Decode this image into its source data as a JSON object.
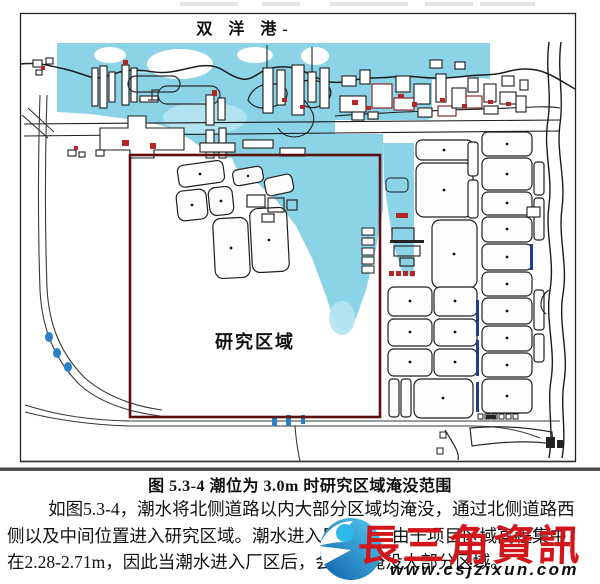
{
  "figure": {
    "port_label": "双  洋  港-",
    "study_area_label": "研究区域",
    "caption": "图 5.3-4  潮位为 3.0m 时研究区域淹没范围",
    "colors": {
      "flood": "#8bd3e7",
      "flood_light": "#b5e4f1",
      "study_area_border": "#5e1010",
      "map_line": "#1c1c1c",
      "road_marker_blue": "#2b7fc4"
    }
  },
  "paragraph": {
    "lines": [
      "如图5.3-4，潮水将北侧道路以内大部分区域均淹没，通过北侧道路西",
      "侧以及中间位置进入研究区域。潮水进入厂区后，由于项目区域高程集中",
      "在2.28-2.71m，因此当潮水进入厂区后，会迅速淹没大部分区域。"
    ]
  },
  "watermark": {
    "brand": "長三角資訊",
    "url": "www.csjzixun.com",
    "brand_color": "#d2171c",
    "logo_gradient_top": "#54cdf2",
    "logo_gradient_bottom": "#0f5ea8"
  }
}
